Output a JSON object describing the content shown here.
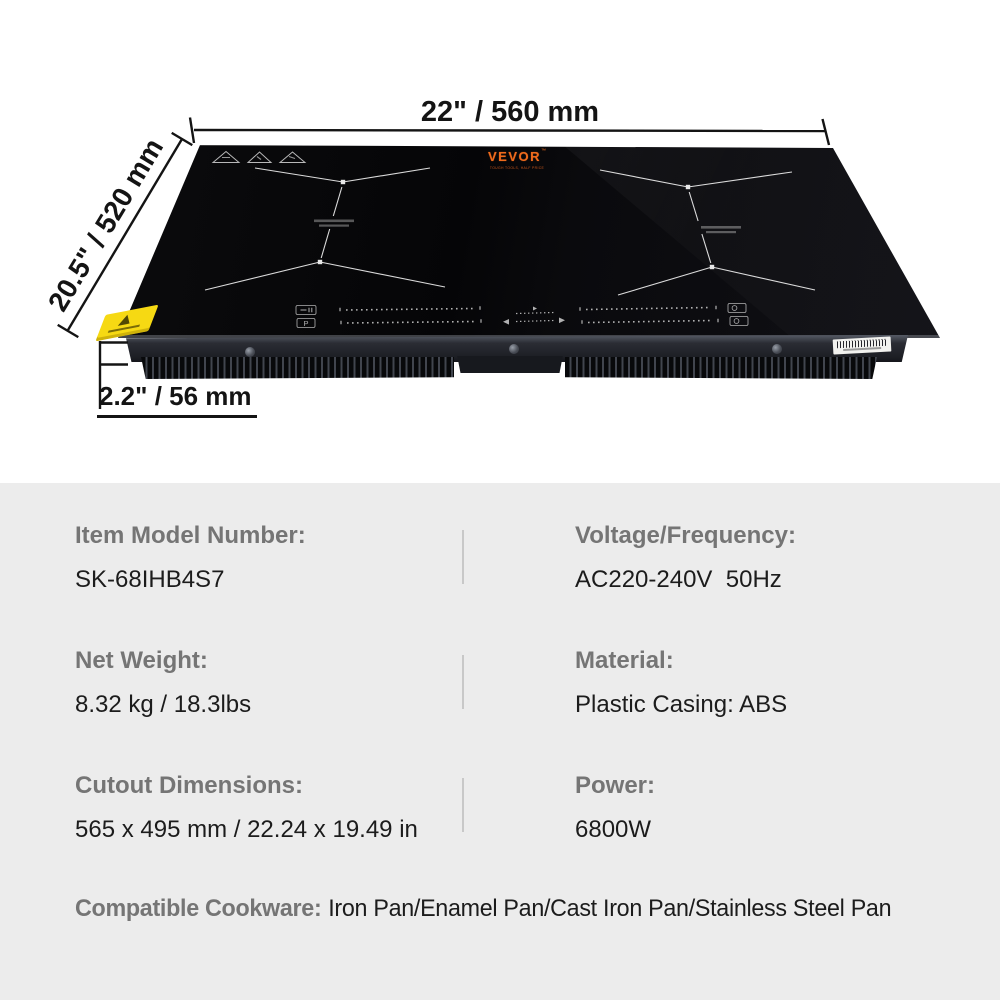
{
  "scene": {
    "dim_width": "22\" / 560 mm",
    "dim_depth": "20.5\" / 520 mm",
    "dim_height": "2.2\" / 56 mm",
    "brand": {
      "name": "VEVOR",
      "tm": "™",
      "tagline": "TOUGH TOOLS, HALF PRICE"
    }
  },
  "specs": {
    "rows": [
      {
        "label": "Item Model Number:",
        "value": "SK-68IHB4S7"
      },
      {
        "label": "Voltage/Frequency:",
        "value": "AC220-240V  50Hz"
      },
      {
        "label": "Net Weight:",
        "value": "8.32 kg / 18.3lbs"
      },
      {
        "label": "Material:",
        "value": "Plastic Casing: ABS"
      },
      {
        "label": "Cutout Dimensions:",
        "value": "565 x 495 mm / 22.24 x 19.49 in"
      },
      {
        "label": "Power:",
        "value": "6800W"
      }
    ],
    "cookware_label": "Compatible Cookware:",
    "cookware_value": "Iron Pan/Enamel Pan/Cast Iron Pan/Stainless Steel Pan"
  },
  "colors": {
    "panel_bg": "#ececec",
    "spec_label_gray": "#757575",
    "spec_value_black": "#1c1c1c",
    "brand_orange": "#ee6a1c",
    "sticker_yellow": "#f6d913",
    "dimension_black": "#141414",
    "glass_black": "#0a0a0d"
  }
}
